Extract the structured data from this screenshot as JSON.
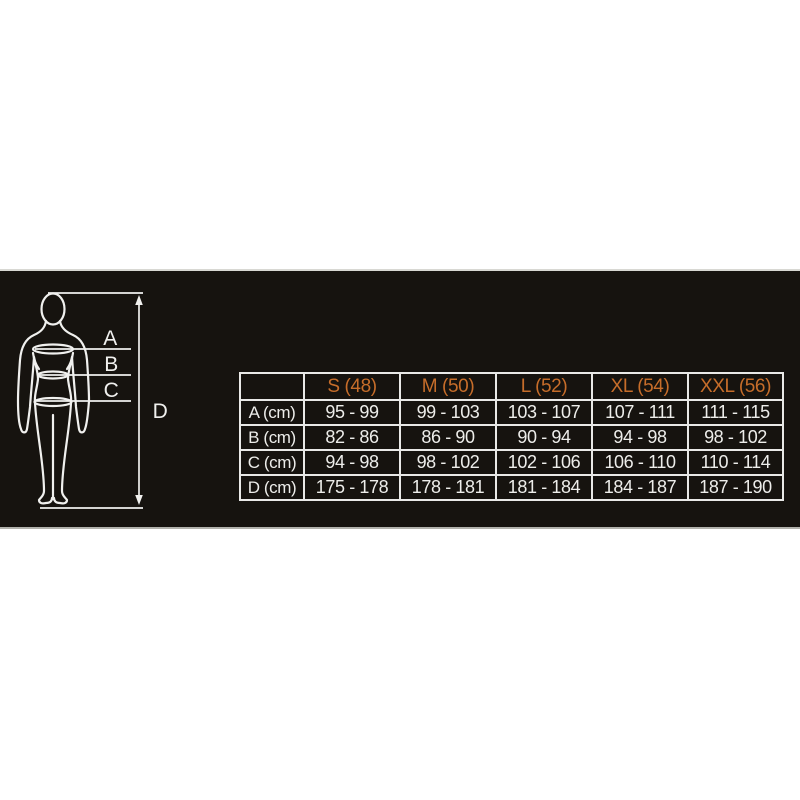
{
  "colors": {
    "page_background": "#ffffff",
    "banner_background": "#16130f",
    "banner_top_edge": "#d8d8d3",
    "banner_bottom_edge": "#b2b2ac",
    "accent_orange": "#c66d2a",
    "text_white": "#ededea",
    "grid_border": "#e9e9e7"
  },
  "figure": {
    "labels": [
      "A",
      "B",
      "C",
      "D"
    ]
  },
  "size_chart": {
    "columns": [
      "",
      "S (48)",
      "M (50)",
      "L (52)",
      "XL (54)",
      "XXL (56)"
    ],
    "rows": [
      {
        "label": "A (cm)",
        "values": [
          "95 - 99",
          "99 - 103",
          "103 - 107",
          "107 - 111",
          "111 - 115"
        ]
      },
      {
        "label": "B (cm)",
        "values": [
          "82 - 86",
          "86 - 90",
          "90 - 94",
          "94 - 98",
          "98 - 102"
        ]
      },
      {
        "label": "C (cm)",
        "values": [
          "94 - 98",
          "98 - 102",
          "102 - 106",
          "106 - 110",
          "110 - 114"
        ]
      },
      {
        "label": "D (cm)",
        "values": [
          "175 - 178",
          "178 - 181",
          "181 - 184",
          "184 - 187",
          "187 - 190"
        ]
      }
    ]
  }
}
